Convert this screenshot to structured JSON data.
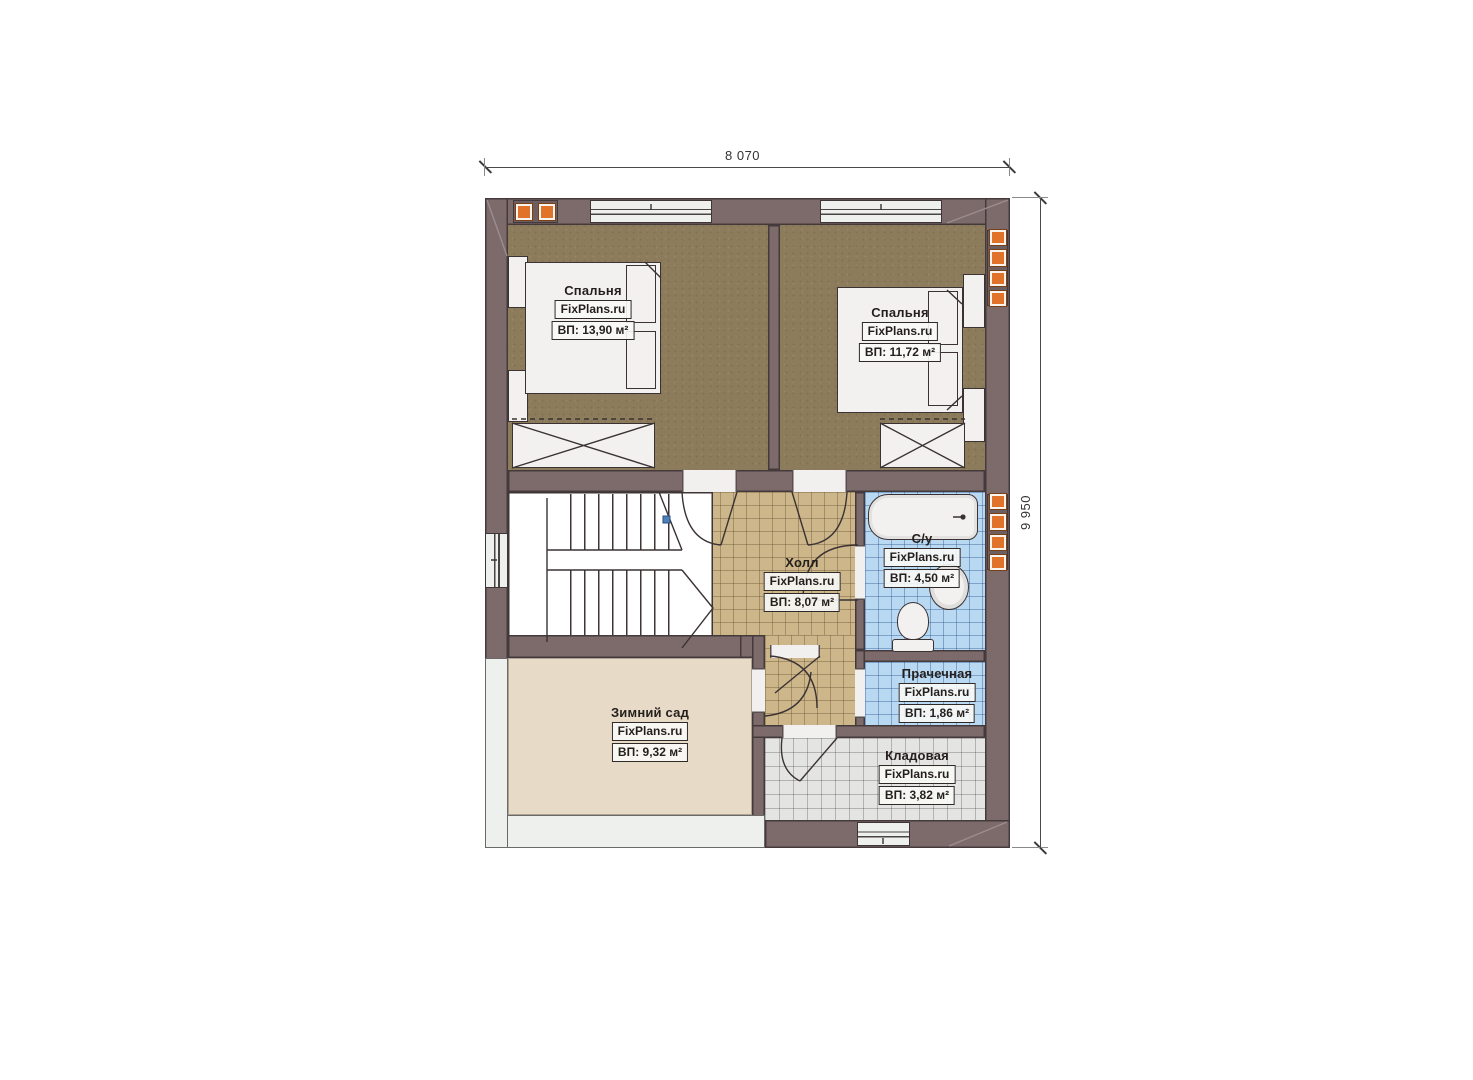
{
  "plan": {
    "title": "second-floor-plan",
    "dimensions": {
      "top": "8 070",
      "right": "9 950"
    },
    "rooms": [
      {
        "id": "bedroom-1",
        "name": "Спальня",
        "brand": "FixPlans.ru",
        "area": "ВП: 13,90 м²"
      },
      {
        "id": "bedroom-2",
        "name": "Спальня",
        "brand": "FixPlans.ru",
        "area": "ВП: 11,72 м²"
      },
      {
        "id": "hall",
        "name": "Холл",
        "brand": "FixPlans.ru",
        "area": "ВП: 8,07 м²"
      },
      {
        "id": "bathroom",
        "name": "С/у",
        "brand": "FixPlans.ru",
        "area": "ВП: 4,50 м²"
      },
      {
        "id": "laundry",
        "name": "Прачечная",
        "brand": "FixPlans.ru",
        "area": "ВП: 1,86 м²"
      },
      {
        "id": "winter-garden",
        "name": "Зимний сад",
        "brand": "FixPlans.ru",
        "area": "ВП: 9,32 м²"
      },
      {
        "id": "storage",
        "name": "Кладовая",
        "brand": "FixPlans.ru",
        "area": "ВП: 3,82 м²"
      }
    ],
    "colors": {
      "wall": "#7d6b6c",
      "wall_outline": "#453a3b",
      "bedroom_floor": "#8d7c5c",
      "hall_tile": "#cdb68a",
      "wet_tile": "#b9d9f2",
      "storage_tile": "#e4e4e2",
      "winter_garden_floor": "#e7dbc7",
      "vent_accent": "#e0722a",
      "door_marker": "#4d7fb8"
    }
  }
}
